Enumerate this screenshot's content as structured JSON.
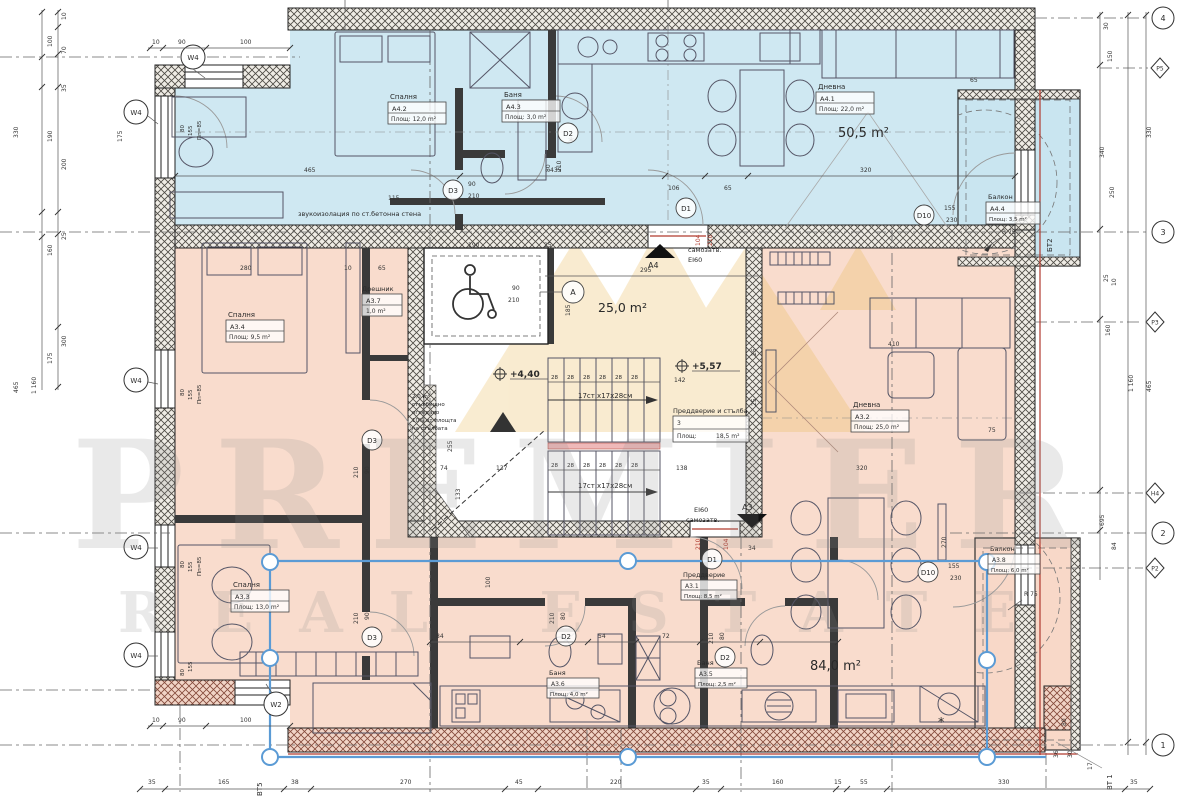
{
  "watermark": {
    "l1": "PREMIER",
    "l2": "REAL ESTATE"
  },
  "totals": {
    "a4": "50,5 m²",
    "a3": "84,0 m²",
    "core": "25,0 m²"
  },
  "labels": {
    "a41n": "Дневна",
    "a41i": "A4.1",
    "a41a": "Площ: 22,0 m²",
    "a42n": "Спалня",
    "a42i": "A4.2",
    "a42a": "Площ: 12,0 m²",
    "a43n": "Баня",
    "a43i": "A4.3",
    "a43a": "Площ: 3,0 m²",
    "a44n": "Балкон",
    "a44i": "A4.4",
    "a44a": "Площ: 3,5 m²",
    "a31n": "Преддверие",
    "a31i": "A3.1",
    "a31a": "Площ: 8,5 m²",
    "a32n": "Дневна",
    "a32i": "A3.2",
    "a32a": "Площ: 25,0 m²",
    "a33n": "Спалня",
    "a33i": "A3.3",
    "a33a": "Площ: 13,0 m²",
    "a34n": "Спалня",
    "a34i": "A3.4",
    "a34a": "Площ: 9,5 m²",
    "a35n": "Баня",
    "a35i": "A3.5",
    "a35a": "Площ: 2,5 m²",
    "a36n": "Баня",
    "a36i": "A3.6",
    "a36a": "Площ: 4,0 m²",
    "a37n": "Дрешник",
    "a37i": "A3.7",
    "a37a": "1,0 m²",
    "a38n": "Балкон",
    "a38i": "A3.8",
    "a38a": "Площ: 6,0 m²"
  },
  "core": {
    "hall_t": "Преддверие и стълба",
    "hall_n": "3",
    "hall_k": "Площ:",
    "hall_v": "18,5 m²",
    "lvl_up": "+5,57",
    "lvl_dn": "+4,40",
    "stairs": "17ст.х17х28см",
    "m1": "2,0 m²",
    "m2": "стълбищно",
    "m3": "огледало",
    "m4": "10% от площта",
    "m5": "на стълбата",
    "sec": "A"
  },
  "notes": {
    "sound": "звукоизолация по ст.бетонна стена",
    "sc": "самозатв.",
    "ei": "EI60",
    "a4": "A4",
    "a3": "A3",
    "r75": "R 75",
    "star": "*"
  },
  "doors": {
    "d1": "D1",
    "d2": "D2",
    "d3": "D3",
    "d10": "D10"
  },
  "win": {
    "w4": "W4",
    "w2": "W2",
    "pp": "Пп=85"
  },
  "grid": {
    "g4": "4",
    "g3": "3",
    "g2": "2",
    "g1": "1",
    "p5": "Р5",
    "p3": "Р3",
    "h4": "Н4",
    "p2": "Р2",
    "bt5": "ВТ5",
    "bt1": "ВТ 1",
    "bt2": "БТ2"
  },
  "d": {
    "n10": "10",
    "n15": "15",
    "n17": "17",
    "n25": "25",
    "n28": "28",
    "n30": "30",
    "n34": "34",
    "n35": "35",
    "n36": "36",
    "n38": "38",
    "n45": "45",
    "n54": "54",
    "n55": "55",
    "n65": "65",
    "n70": "70",
    "n72": "72",
    "n74": "74",
    "n75": "75",
    "n80": "80",
    "n84": "84",
    "n90": "90",
    "n100": "100",
    "n104": "104",
    "n106": "106",
    "n115": "115",
    "n133": "133",
    "n137": "137",
    "n138": "138",
    "n142": "142",
    "n150": "150",
    "n155": "155",
    "n160": "160",
    "n165": "165",
    "n175": "175",
    "n185": "185",
    "n190": "190",
    "n200": "200",
    "n210": "210",
    "n220": "220",
    "n230": "230",
    "n250": "250",
    "n255": "255",
    "n270": "270",
    "n280": "280",
    "n295": "295",
    "n300": "300",
    "n320": "320",
    "n330": "330",
    "n340": "340",
    "n410": "410",
    "n435": "435",
    "n465": "465",
    "n695": "695",
    "n1160": "1 160"
  }
}
